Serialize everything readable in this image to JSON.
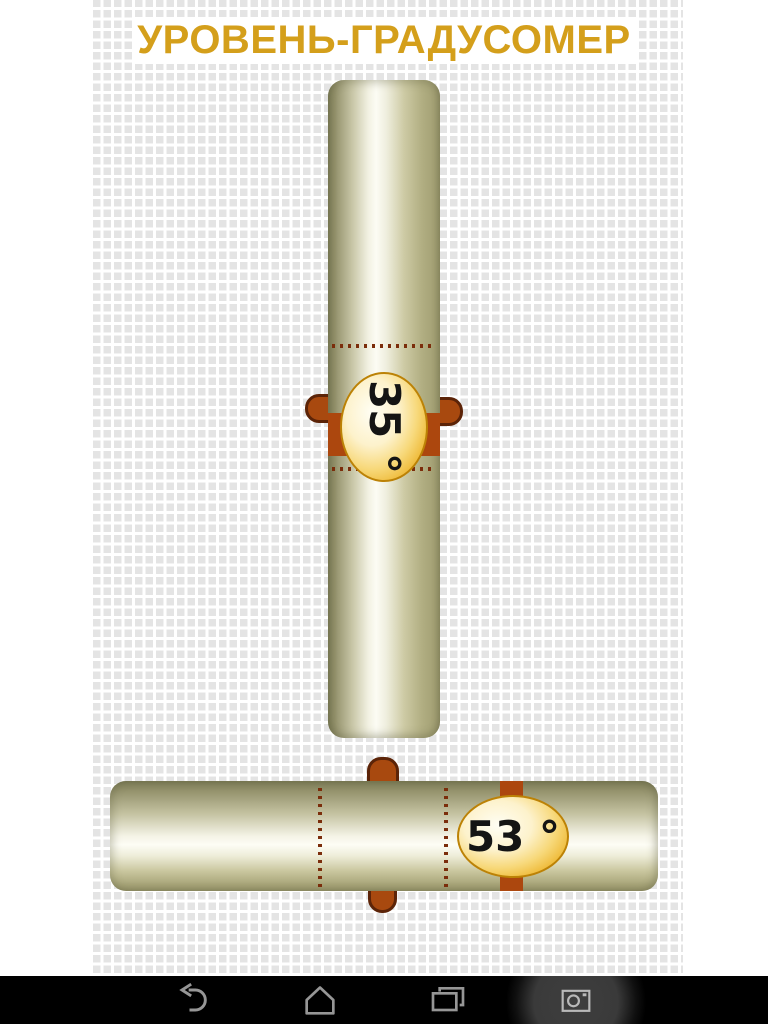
{
  "app": {
    "title": "УРОВЕНЬ-ГРАДУСОМЕР"
  },
  "levels": {
    "vertical": {
      "reading": "35 °",
      "value": 35,
      "unit": "°"
    },
    "horizontal": {
      "reading": "53 °",
      "value": 53,
      "unit": "°"
    }
  },
  "colors": {
    "title_gold": "#d49f1b",
    "bubble_gold": "#edb52e",
    "bubble_border": "#bc8206",
    "clamp_red": "#ac470e",
    "tab_outline": "#5c2408",
    "tube_olive": "#9a976c",
    "grid_gray": "#e4e4e4",
    "navbar_black": "#000000",
    "nav_icon_gray": "#969696"
  },
  "navbar": {
    "icons": [
      {
        "name": "back-icon"
      },
      {
        "name": "home-icon"
      },
      {
        "name": "recents-icon"
      },
      {
        "name": "camera-icon"
      }
    ]
  }
}
